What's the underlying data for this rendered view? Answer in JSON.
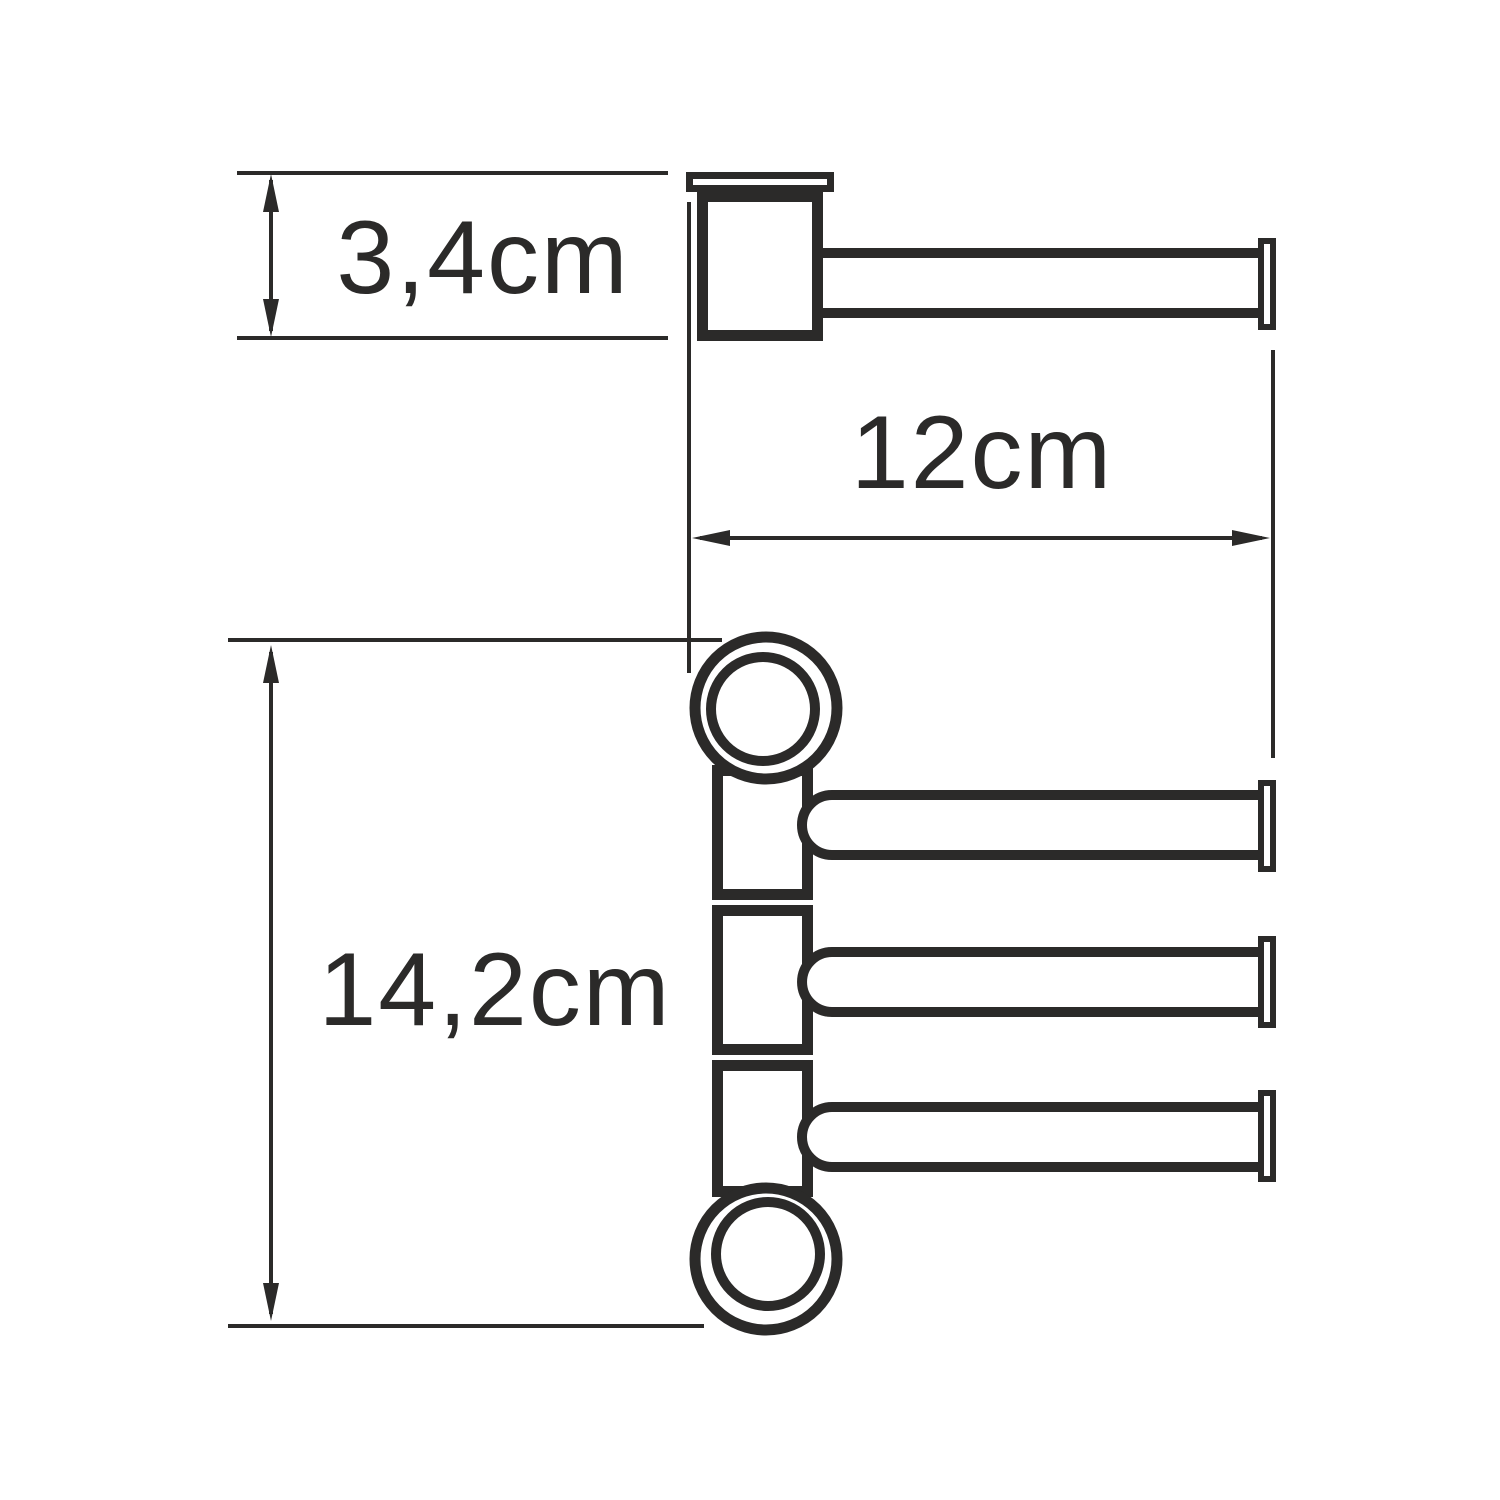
{
  "drawing": {
    "background_color": "#ffffff",
    "ink_color": "#2b2a29",
    "dimensions": {
      "mount_height": {
        "label": "3,4cm",
        "value_cm": 3.4,
        "orientation": "vertical"
      },
      "bar_length": {
        "label": "12cm",
        "value_cm": 12,
        "orientation": "horizontal"
      },
      "column_height": {
        "label": "14,2cm",
        "value_cm": 14.2,
        "orientation": "vertical"
      }
    }
  }
}
